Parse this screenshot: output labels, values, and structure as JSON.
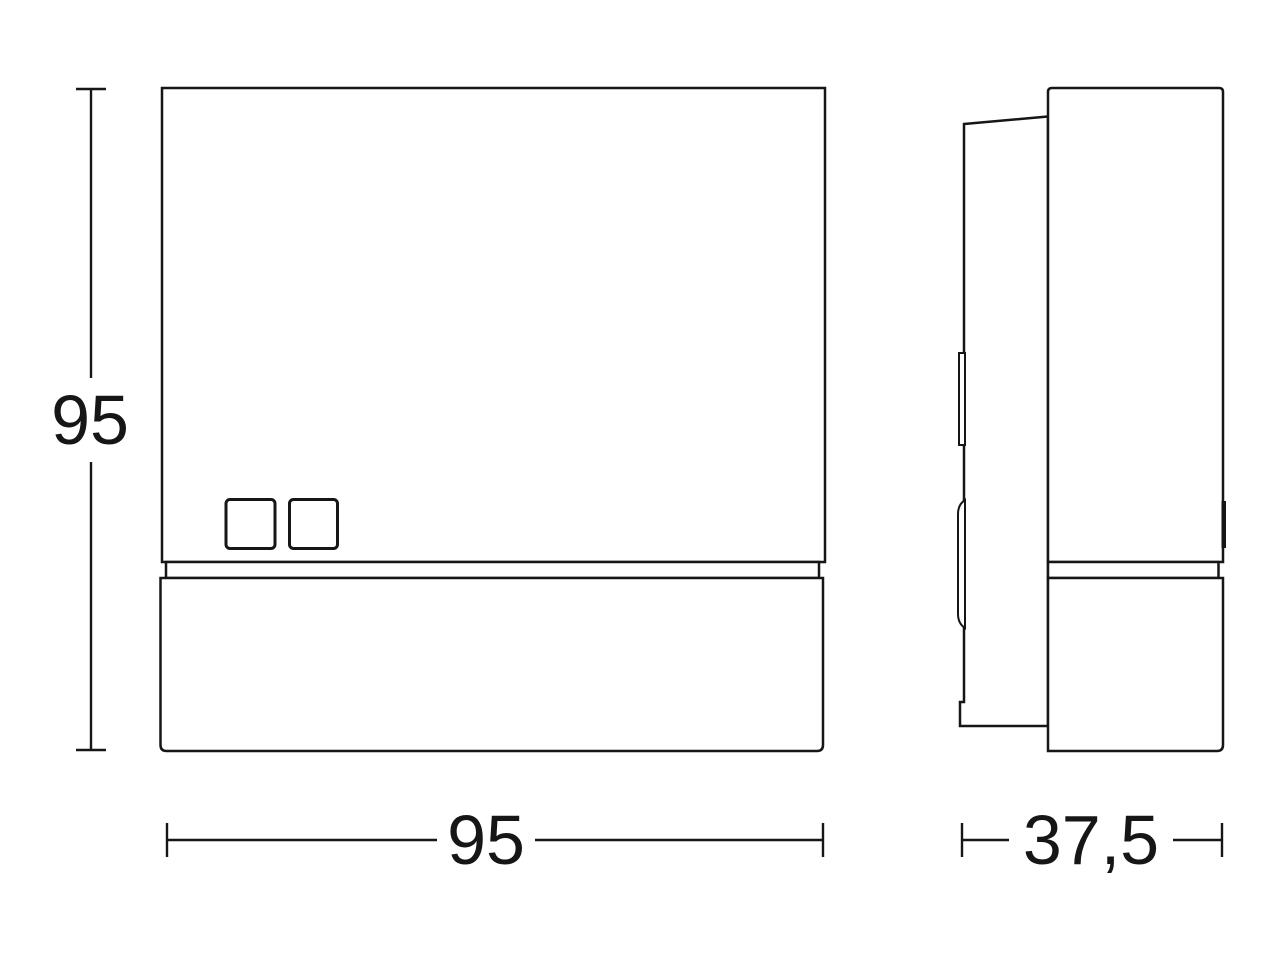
{
  "dimensions": {
    "height_mm": "95",
    "width_mm": "95",
    "depth_mm": "37,5"
  },
  "colors": {
    "line": "#161616",
    "background": "#ffffff"
  }
}
